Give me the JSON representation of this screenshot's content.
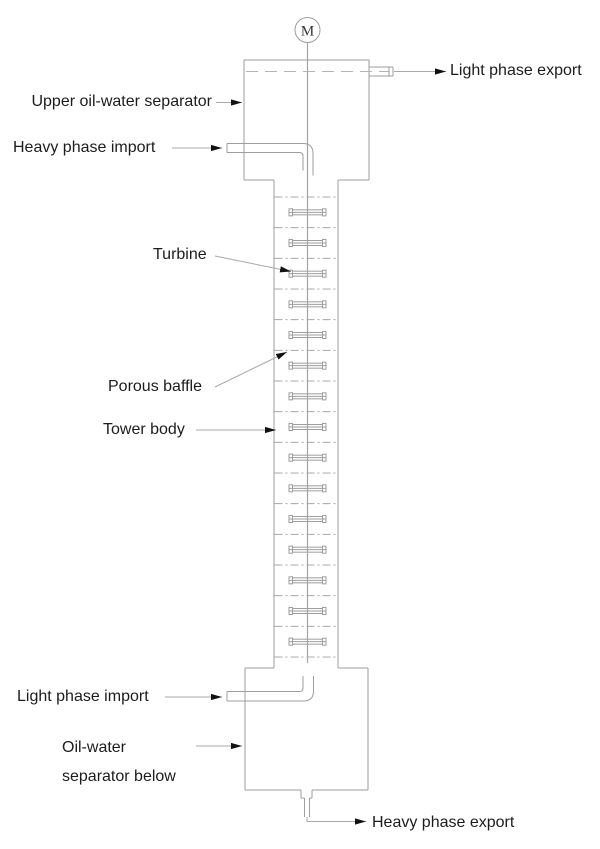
{
  "diagram": {
    "motor_symbol": "M",
    "labels": {
      "light_phase_export": "Light phase export",
      "upper_separator": "Upper oil-water separator",
      "heavy_phase_import": "Heavy phase import",
      "turbine": "Turbine",
      "porous_baffle": "Porous baffle",
      "tower_body": "Tower body",
      "light_phase_import": "Light phase import",
      "lower_separator_line1": "Oil-water",
      "lower_separator_line2": "separator below",
      "heavy_phase_export": "Heavy phase export"
    },
    "internals": {
      "baffle_count": 16,
      "turbine_count": 15,
      "first_baffle_y": 197,
      "spacing": 30.667,
      "tower_left": 274,
      "tower_right": 338,
      "center_x": 307.5,
      "turbine_width": 37,
      "turbine_height": 7
    },
    "colors": {
      "line": "#9e9e9e",
      "leader": "#a8a8a8",
      "dashed_level": "#b5b5b5",
      "arrow": "#111111",
      "text": "#1c1c1c",
      "background": "#ffffff"
    }
  }
}
